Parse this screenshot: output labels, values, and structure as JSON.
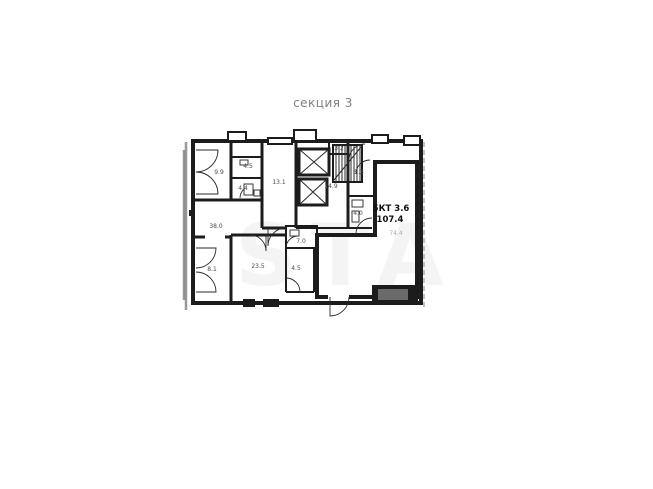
{
  "title": "секция 3",
  "watermark": "STA",
  "plan": {
    "rooms": [
      {
        "id": "room-9-9",
        "area": "9.9"
      },
      {
        "id": "room-4-5-top",
        "area": "4.5"
      },
      {
        "id": "room-4-4",
        "area": "4.4"
      },
      {
        "id": "hall-13-1",
        "area": "13.1"
      },
      {
        "id": "room-3-2",
        "area": "3.2"
      },
      {
        "id": "corridor-14-9",
        "area": "14.9"
      },
      {
        "id": "room-5-3",
        "area": "5.3"
      },
      {
        "id": "room-4-0",
        "area": "4.0"
      },
      {
        "id": "room-38-0",
        "area": "38.0"
      },
      {
        "id": "room-7-0",
        "area": "7.0"
      },
      {
        "id": "room-23-5",
        "area": "23.5"
      },
      {
        "id": "room-4-5-bottom",
        "area": "4.5"
      },
      {
        "id": "room-8-1",
        "area": "8.1"
      }
    ],
    "unit": {
      "type_label": "5КТ 3.6",
      "total_area": "107.4",
      "living_area": "74.4"
    },
    "colors": {
      "wall": "#1c1c1c",
      "unit_fill": "#e4e4e4",
      "room_label": "#4a4a4a",
      "muted_label": "#aaaaaa",
      "title_text": "#7f7f7f"
    }
  }
}
